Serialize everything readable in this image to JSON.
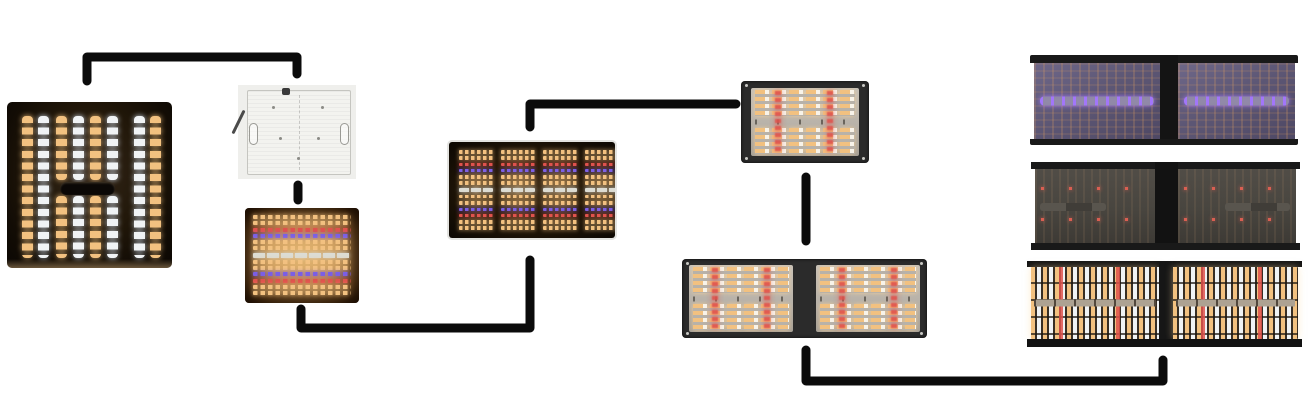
{
  "diagram": {
    "kind": "led-grow-light-board-evolution-flow",
    "background_color": "#ffffff",
    "connector": {
      "color": "#0b0b0b",
      "thickness": 9
    },
    "palette": {
      "warm_led": "#f2c180",
      "cool_led": "#f0f3f5",
      "red_led": "#e0524c",
      "blue_led": "#7a5fe6",
      "silver_led": "#dcdcd4",
      "uv_led": "#a276fa",
      "uv_board": "#5d5775",
      "red_dot_led": "#d95f52",
      "board_gray": "#b8b2a9",
      "dark_board": "#48453f",
      "frame_black": "#2b2b2b",
      "connector_line": "#0b0b0b",
      "back_plate_white": "#f3f3ef",
      "photo_background": "#efefec"
    },
    "spectrum_rows": [
      "warm",
      "warm",
      "red",
      "blue",
      "warm",
      "warm",
      "silver",
      "warm",
      "warm",
      "blue",
      "red",
      "warm",
      "warm"
    ],
    "nodes": [
      {
        "id": "square-board-lit",
        "name": "square LED board lit with warm and cool white columns",
        "x": 7,
        "y": 102,
        "w": 165,
        "h": 166,
        "type": "square"
      },
      {
        "id": "board-back",
        "name": "LED board rear aluminum plate",
        "x": 238,
        "y": 85,
        "w": 118,
        "h": 94,
        "type": "back"
      },
      {
        "id": "board-lit-glow",
        "name": "LED board lit warm with red and blue rows",
        "x": 245,
        "y": 208,
        "w": 114,
        "h": 95,
        "type": "glow",
        "rows": true
      },
      {
        "id": "board-strips-lit",
        "name": "dark LED board lit with four strip groups",
        "x": 449,
        "y": 142,
        "w": 166,
        "h": 96,
        "type": "strips",
        "rows": true
      },
      {
        "id": "framed-board",
        "name": "framed gray LED board with warm LEDs and red accents",
        "x": 741,
        "y": 81,
        "w": 128,
        "h": 82,
        "type": "framed"
      },
      {
        "id": "framed-dual-board",
        "name": "wide dual LED board with warm LEDs and red accents",
        "x": 682,
        "y": 259,
        "w": 245,
        "h": 79,
        "type": "framed-wide"
      },
      {
        "id": "dual-board-uv",
        "name": "wide dual board with UV channel lit",
        "x": 1030,
        "y": 55,
        "w": 268,
        "h": 90,
        "type": "uv"
      },
      {
        "id": "dual-board-red",
        "name": "wide dual board with red channel lit",
        "x": 1031,
        "y": 162,
        "w": 269,
        "h": 88,
        "type": "redonly"
      },
      {
        "id": "dual-board-full",
        "name": "wide dual board fully lit",
        "x": 1027,
        "y": 261,
        "w": 275,
        "h": 86,
        "type": "full"
      }
    ],
    "connectors": [
      {
        "id": "link-square-to-back",
        "points": "87,81 87,57 297,57 297,74"
      },
      {
        "id": "link-back-to-glow",
        "points": "298,185 298,200"
      },
      {
        "id": "link-glow-to-strips",
        "points": "301,309 301,328 530,328 530,260"
      },
      {
        "id": "link-strips-to-framed",
        "points": "530,127 530,104 736,104"
      },
      {
        "id": "link-framed-to-dual",
        "points": "806,177 806,241"
      },
      {
        "id": "link-dual-to-full",
        "points": "806,350 806,381 1163,381 1163,360"
      }
    ]
  }
}
